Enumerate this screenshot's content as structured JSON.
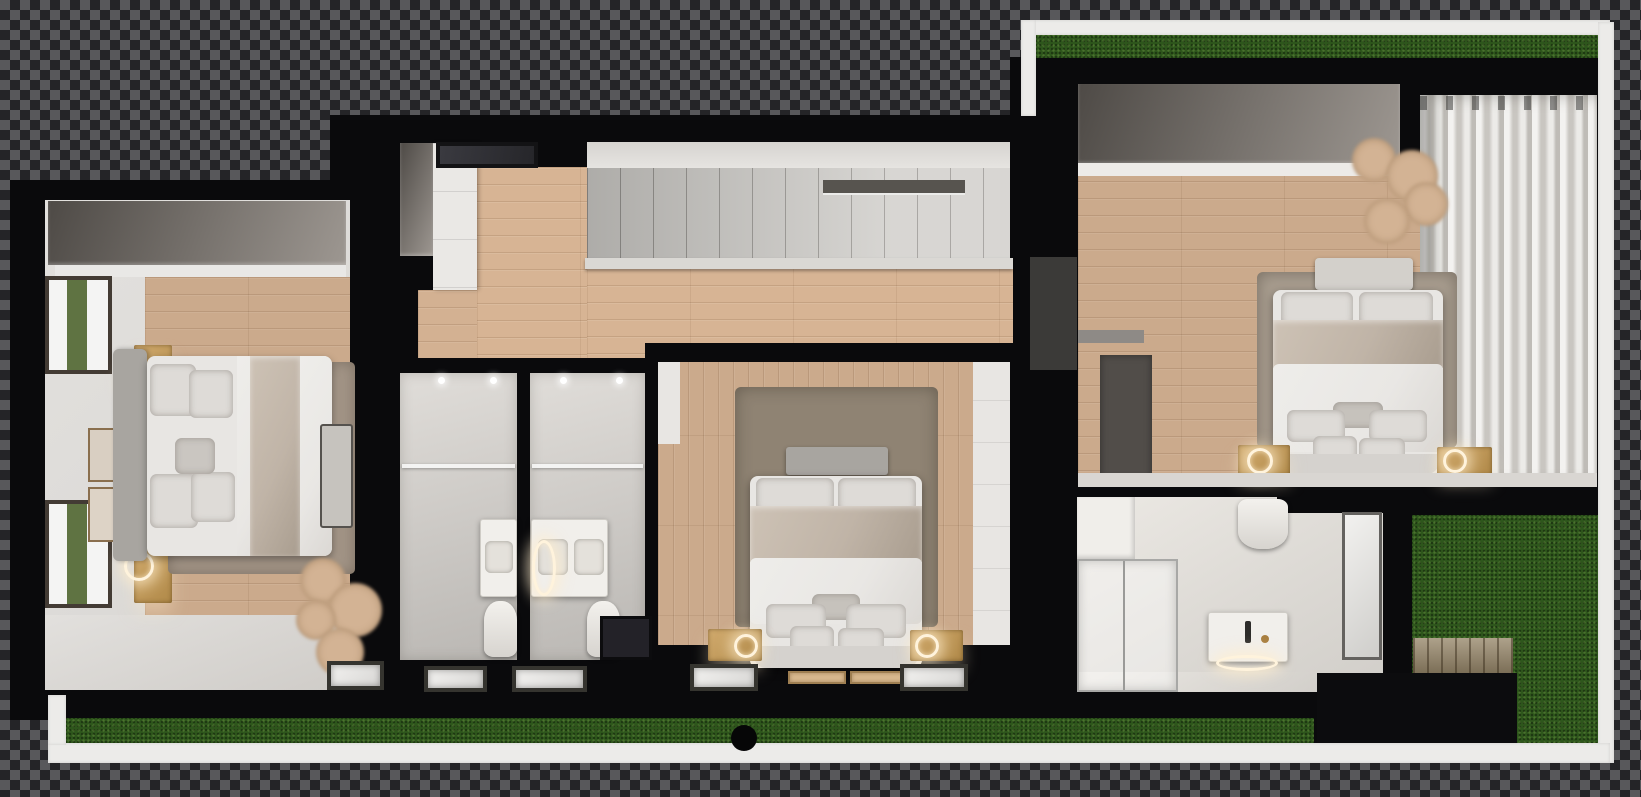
{
  "scene": {
    "type": "top-down-3d-floor-plan-render",
    "background": "transparency-checkerboard",
    "rooms": [
      {
        "id": "left-bedroom",
        "features": [
          "double-bed",
          "headboard",
          "rug",
          "bench",
          "two-nightstands",
          "wall-ring-lamps",
          "two-garden-windows",
          "picture-frames",
          "wardrobe-row",
          "pampas-plant"
        ]
      },
      {
        "id": "hallway-staircase",
        "features": [
          "staircase",
          "stair-void",
          "railing",
          "skylight",
          "tall-cabinet",
          "wardrobe-panel",
          "wood-floor"
        ]
      },
      {
        "id": "bathroom-one",
        "features": [
          "glass-shower",
          "toilet",
          "vanity-sink",
          "floor-window",
          "ceiling-lights"
        ]
      },
      {
        "id": "bathroom-two",
        "features": [
          "glass-shower",
          "toilet",
          "double-vanity",
          "ring-light",
          "floor-window",
          "ceiling-lights"
        ]
      },
      {
        "id": "center-bedroom",
        "features": [
          "double-bed",
          "headboard",
          "rug",
          "two-nightstands",
          "closet-wall",
          "floor-windows",
          "door-mats",
          "dark-niche"
        ]
      },
      {
        "id": "right-bedroom",
        "features": [
          "double-bed",
          "headboard",
          "rug",
          "two-nightstands",
          "ring-lamps",
          "sheer-curtains",
          "wardrobe-row",
          "pampas-plant",
          "desk",
          "wall-shelf",
          "gray-door"
        ]
      },
      {
        "id": "right-bathroom",
        "features": [
          "glass-shower",
          "toilet",
          "marble-vanity",
          "mirror",
          "white-cabinet"
        ]
      },
      {
        "id": "garden",
        "features": [
          "top-lawn-strip",
          "bottom-lawn-strip",
          "right-lawn",
          "wood-deck",
          "dark-patio",
          "round-marker"
        ]
      }
    ]
  },
  "palette": {
    "checkerDark": "#242427",
    "checkerLight": "#58585b",
    "wall": "#0a0a0c",
    "frameWhite": "#ecebe9",
    "grass": "#2e561c",
    "woodFloor": "#cbaa8c",
    "stairTread": "#cfcdc9",
    "roomWall": "#dcdad7",
    "wardrobeDark": "#4e4a46",
    "wardrobeLight": "#9d9791",
    "rugLeft": "#a29486",
    "rugCenter": "#8f8373",
    "rugRight": "#a89d8f",
    "duvet": "#e9e7e4",
    "blanket": "#c0b4a7",
    "pillow": "#dedbd7",
    "headboard": "#a8a5a0",
    "headboardLight": "#d3d0cb",
    "nightstand": "#b08948",
    "deck": "#97876a",
    "glow": "#fff3dc",
    "curtainLight": "#f3f2f0",
    "curtainDark": "#c9c6c1",
    "windowFrame": "#433b34",
    "greenStrip": "#5f7342",
    "bench": "#c6c3be",
    "plant": "#d3b394",
    "mirrorFrame": "#64625f",
    "niche": "#232228",
    "marker": "#060607",
    "grayDoor": "#3b3a38",
    "desk": "#514d49"
  }
}
